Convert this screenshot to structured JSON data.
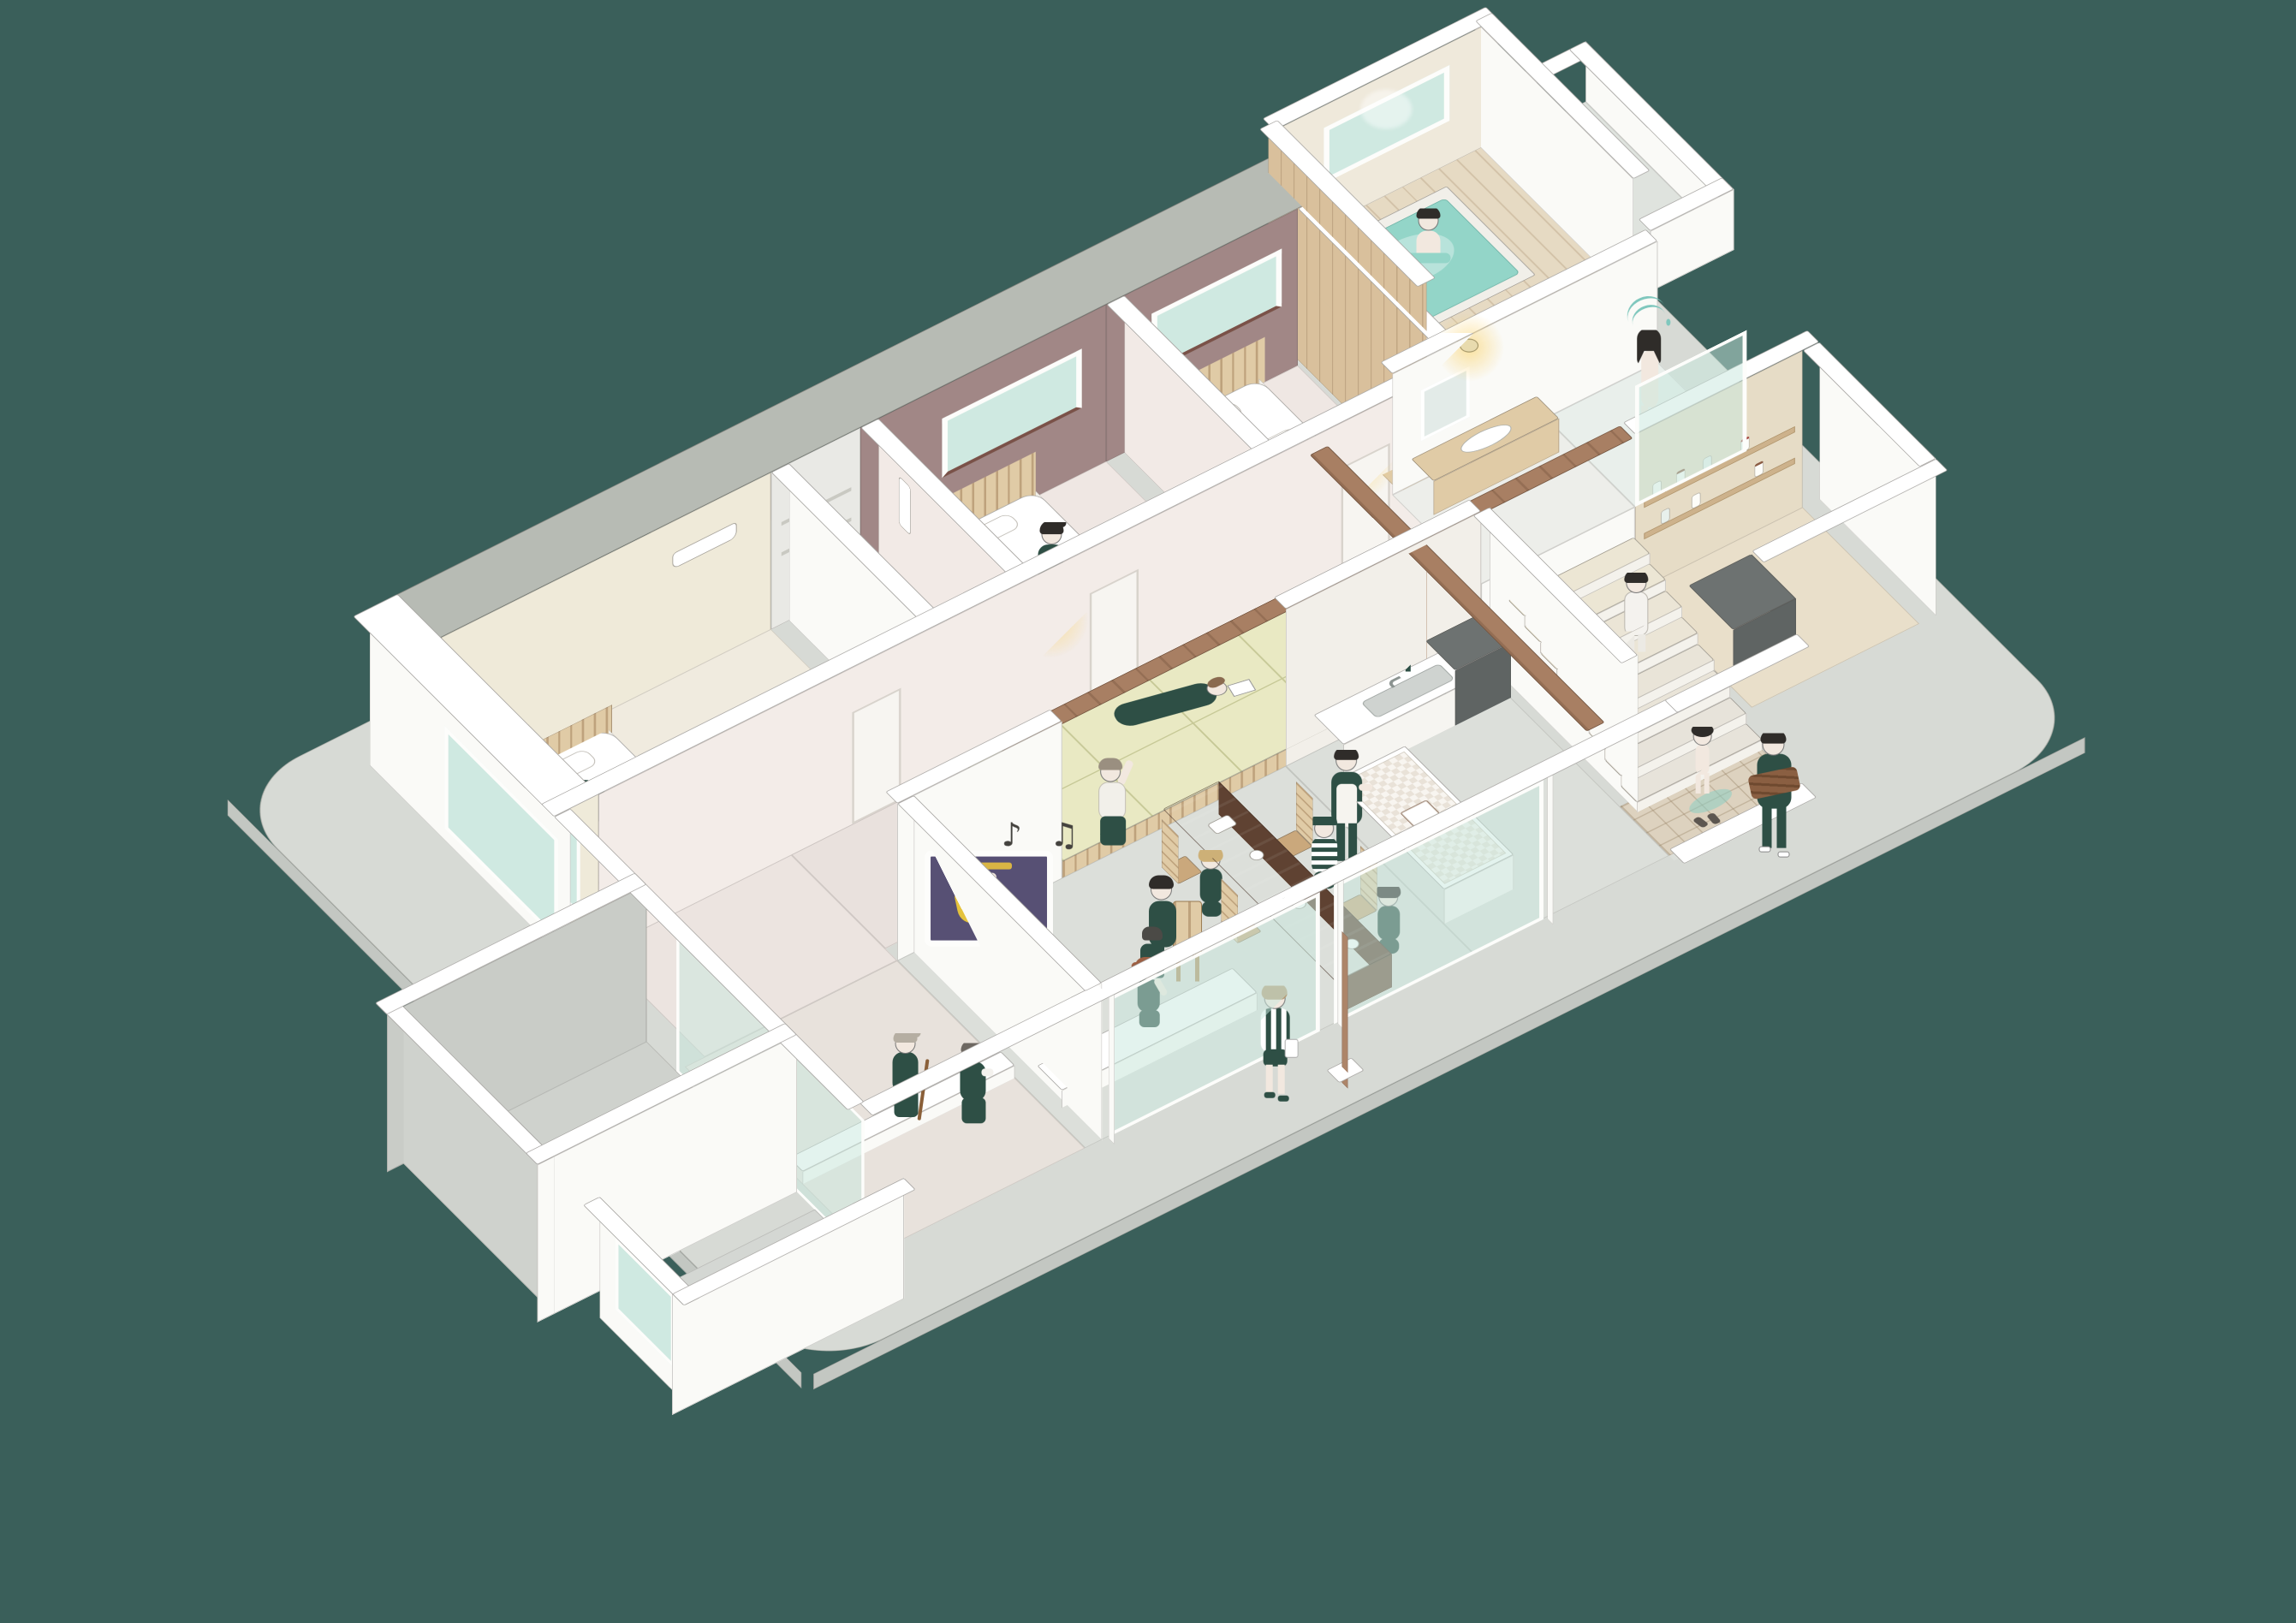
{
  "palette": {
    "bg": "#3a5f5a",
    "slab": "#d7dad5",
    "slab-edge": "#c3c7c2",
    "wall": "#fafaf7",
    "cap": "#ffffff",
    "gray-band": "#b7bbb4",
    "floor-gray": "#dcdfda",
    "floor-pink": "#efe7e3",
    "hall": "#ece3df",
    "beige": "#efead9",
    "mauve": "#a18786",
    "wood-light": "#e0cba6",
    "wood-mid": "#ad8569",
    "wood-dark": "#6f4f3d",
    "wood-beam": "#a87f63",
    "tatami": "#e9e9c3",
    "tatami-line": "#c6c896",
    "mint": "#cfe9e1",
    "water": "#93d5c8",
    "green": "#2e4f45",
    "skin": "#f2e8df",
    "hair-brown": "#8a6a4f",
    "hair-dark": "#2f2c29",
    "hair-gray": "#b5aea2",
    "tan": "#e6dcc6",
    "shelf": "#cdb28c",
    "dark-gray": "#6d7271",
    "tile": "#ddd2bf",
    "poster": "#575074"
  },
  "scene": {
    "type": "isometric cutaway illustration of a family house",
    "music_notes": "♪ ♫",
    "rooms": [
      {
        "name": "master-bedroom",
        "detail": "person napping on white bed, wood slat headboard, beige walls, AC unit"
      },
      {
        "name": "bedroom-2",
        "detail": "person in green sitting on bed, mauve accent wall with window"
      },
      {
        "name": "bedroom-3",
        "detail": "empty made bed, mauve accent wall with window, hallway lamp"
      },
      {
        "name": "closet",
        "detail": "small storage room with shelves"
      },
      {
        "name": "tatami-room",
        "detail": "raised platform, person lying reading, elder sitting on edge waving"
      },
      {
        "name": "living-room",
        "detail": "person on wooden chair watching screen showing dancing couple, music notes"
      },
      {
        "name": "dining-room",
        "detail": "long walnut table, spindle chairs, three children having snacks"
      },
      {
        "name": "kitchen",
        "detail": "apron man reading cookbook at checkered island, woman washing at sink counter"
      },
      {
        "name": "stairs",
        "detail": "person in white climbing, bare child at bottom on wet mat"
      },
      {
        "name": "washroom",
        "detail": "wood basin counter with warm lamp"
      },
      {
        "name": "shower-room",
        "detail": "person showering behind glass"
      },
      {
        "name": "bathroom",
        "detail": "person soaking in sunken teal tub, wood plank wall, big window"
      },
      {
        "name": "pantry",
        "detail": "tan walls, wood shelves with preserve jars, dark counter"
      },
      {
        "name": "entry",
        "detail": "tiled genkan, man carrying firewood on terrace"
      },
      {
        "name": "engawa",
        "detail": "two elderly people resting on step, one with cane"
      },
      {
        "name": "window-bench",
        "detail": "girl sitting in sunken window seat"
      },
      {
        "name": "court",
        "detail": "open walled yard on the left wing"
      },
      {
        "name": "terrace",
        "detail": "child in striped shirt walking with white bag"
      }
    ],
    "people_activities": [
      "napping",
      "sitting on bed",
      "soaking in bath",
      "showering",
      "climbing stairs",
      "after-bath child",
      "washing dishes",
      "reading cookbook",
      "snacking",
      "wearing cap",
      "sitting at table",
      "watching movie with cat",
      "resting with cane",
      "chatting",
      "sitting on bench",
      "carrying firewood",
      "walking with bag",
      "reading on tatami",
      "waving elder"
    ]
  }
}
